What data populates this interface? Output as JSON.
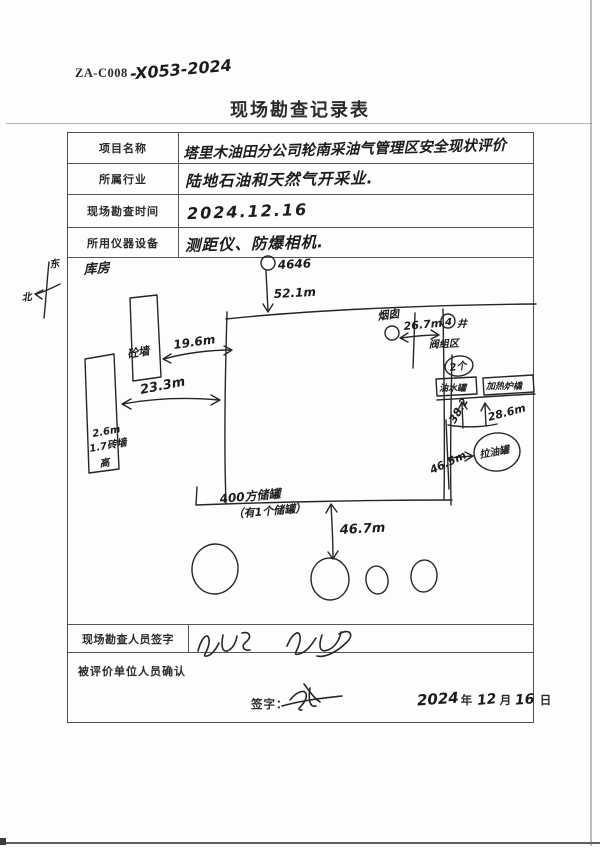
{
  "page": {
    "doc_code_printed": "ZA-C008",
    "doc_code_handwritten": "-X053-2024",
    "title": "现场勘查记录表"
  },
  "form": {
    "rows": [
      {
        "label": "项目名称",
        "value": "塔里木油田分公司轮南采油气管理区安全现状评价"
      },
      {
        "label": "所属行业",
        "value": "陆地石油和天然气开采业."
      },
      {
        "label": "现场勘查时间",
        "value": "2024.12.16"
      },
      {
        "label": "所用仪器设备",
        "value": "测距仪、防爆相机."
      }
    ],
    "surveyor_row_label": "现场勘查人员签字",
    "confirm_row_label": "被评价单位人员确认",
    "sign_prefix": "签字：",
    "date": {
      "year": "2024",
      "year_unit": "年",
      "month": "12",
      "month_unit": "月",
      "day": "16",
      "day_unit": "日"
    }
  },
  "sketch": {
    "compass_char_top": "东",
    "compass_char_bottom": "北",
    "storeroom_label": "库房",
    "small_wall_label": "砼墙",
    "dist_19_6": "19.6m",
    "dist_23_3": "23.3m",
    "left_wall_line1": "2.6m",
    "left_wall_line2": "1.7砖墙",
    "left_wall_line3": "高",
    "pole_number": "4646",
    "dist_52_1": "52.1m",
    "chimney_label": "烟囱",
    "dist_26_7": "26.7m",
    "well_number": "4",
    "well_unit": "井",
    "valve_area_label": "阀组区",
    "count_label": "2个",
    "box1_label": "油水罐",
    "box2_label": "加热炉橇",
    "dist_38_2": "38.2",
    "dist_28_6": "28.6m",
    "oil_tank_circle_label": "拉油罐",
    "dist_46_5": "46.5m",
    "tank_area_line1": "400方储罐",
    "tank_area_line2": "（有1个储罐）",
    "dist_46_7": "46.7m"
  }
}
